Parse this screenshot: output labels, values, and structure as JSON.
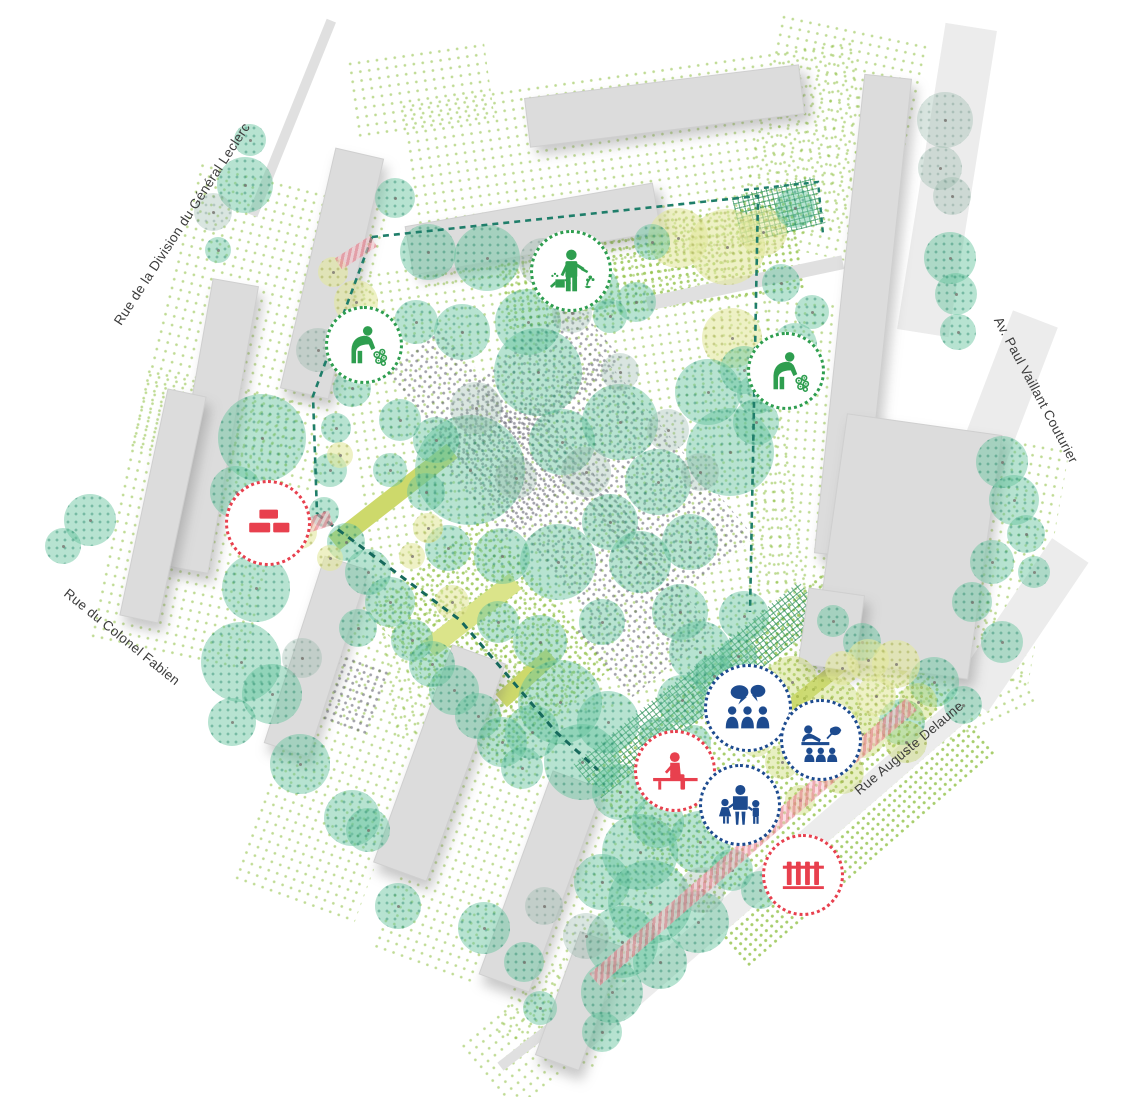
{
  "map": {
    "title": "Park landscape site plan",
    "streets": [
      {
        "id": "leclerc",
        "label": "Rue de la Division du Général Leclerc"
      },
      {
        "id": "couturier",
        "label": "Av. Paul Vaillant Couturier"
      },
      {
        "id": "fabien",
        "label": "Rue du Colonel Fabien"
      },
      {
        "id": "delaune",
        "label": "Rue Auguste Delaune"
      }
    ],
    "icons": [
      {
        "id": "watering",
        "name": "gardener-watering-icon",
        "color": "#2e9e4f"
      },
      {
        "id": "planting-1",
        "name": "gardener-planting-flowers-icon",
        "color": "#2e9e4f"
      },
      {
        "id": "planting-2",
        "name": "gardener-planting-flowers-icon",
        "color": "#2e9e4f"
      },
      {
        "id": "bricks",
        "name": "bricks-construction-icon",
        "color": "#e8404e"
      },
      {
        "id": "discussion",
        "name": "group-discussion-icon",
        "color": "#1d4b8f"
      },
      {
        "id": "workshop",
        "name": "nature-workshop-table-icon",
        "color": "#1d4b8f"
      },
      {
        "id": "bench",
        "name": "person-on-bench-icon",
        "color": "#e8404e"
      },
      {
        "id": "children",
        "name": "adult-with-children-icon",
        "color": "#1d4b8f"
      },
      {
        "id": "fence",
        "name": "fence-icon",
        "color": "#e8404e"
      }
    ],
    "palette": {
      "tree_teal": "#68c59e",
      "tree_yellow": "#e3e79e",
      "tree_lime": "#cddc78",
      "building_gray": "#dcdcdc",
      "path_lime": "#cdd96b",
      "accent_pink": "#eb8e9b",
      "dashed_teal": "#1f7e6a",
      "icon_green": "#2e9e4f",
      "icon_red": "#e8404e",
      "icon_blue": "#1d4b8f"
    }
  }
}
